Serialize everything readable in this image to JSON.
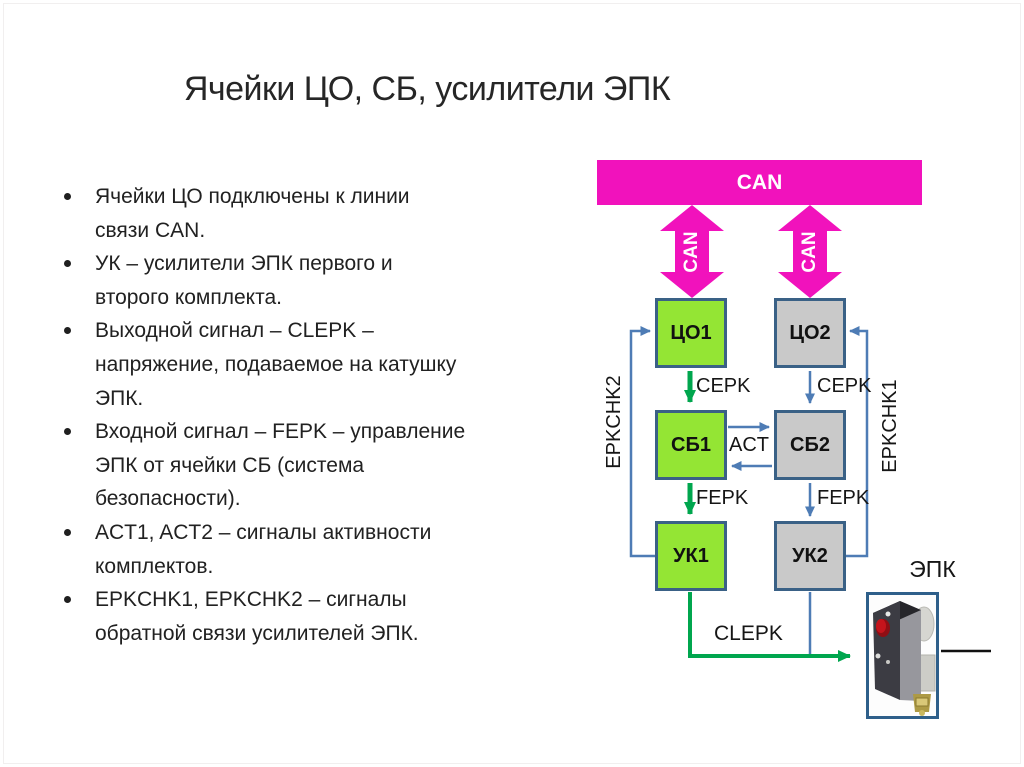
{
  "slide": {
    "title": "Ячейки ЦО, СБ, усилители ЭПК",
    "bullets": [
      "Ячейки ЦО подключены к линии\nсвязи CAN.",
      "УК – усилители ЭПК первого и\nвторого комплекта.",
      "Выходной сигнал – CLEPK –\nнапряжение, подаваемое на катушку\nЭПК.",
      "Входной сигнал – FEPK – управление\nЭПК от ячейки СБ (система\nбезопасности).",
      "ACT1, ACT2 – сигналы активности\nкомплектов.",
      "EPKCHK1, EPKCHK2 – сигналы\nобратной связи усилителей ЭПК."
    ]
  },
  "diagram": {
    "can_bus": "CAN",
    "can_link_left": "CAN",
    "can_link_right": "CAN",
    "boxes": {
      "co1": "ЦО1",
      "co2": "ЦО2",
      "sb1": "СБ1",
      "sb2": "СБ2",
      "uk1": "УК1",
      "uk2": "УК2"
    },
    "signals": {
      "cepk_left": "CEPK",
      "cepk_right": "CEPK",
      "act": "ACT",
      "fepk_left": "FEPK",
      "fepk_right": "FEPK",
      "clepk": "CLEPK",
      "epkchk2": "EPKCHK2",
      "epkchk1": "EPKCHK1"
    },
    "epk_device_label": "ЭПК"
  },
  "colors": {
    "can_magenta": "#F112BC",
    "box_green": "#94E534",
    "box_gray": "#C9C9C9",
    "box_border": "#3A6186",
    "line_blue": "#4E7CB5",
    "line_green": "#00A64E",
    "text": "#1A1A1A"
  }
}
